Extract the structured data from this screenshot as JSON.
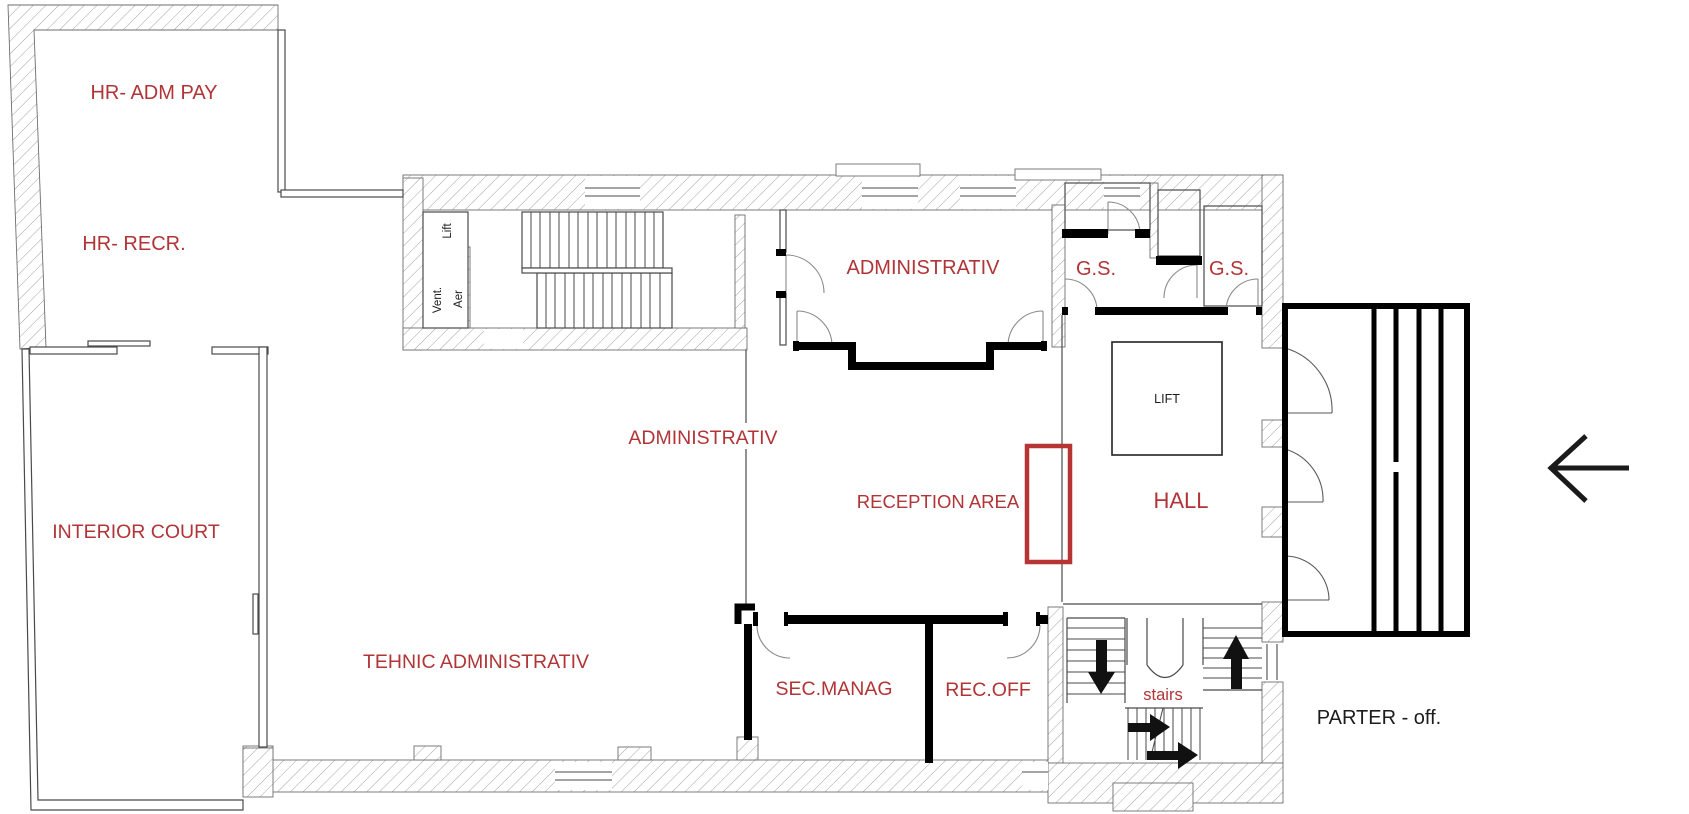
{
  "plan": {
    "floor_label": "PARTER - off.",
    "rooms": {
      "hr_adm_pay": "HR- ADM PAY",
      "hr_recr": "HR- RECR.",
      "interior_court": "INTERIOR COURT",
      "tehnic_administrativ": "TEHNIC ADMINISTRATIV",
      "administrativ_corridor": "ADMINISTRATIV",
      "administrativ_room": "ADMINISTRATIV",
      "reception_area": "RECEPTION AREA",
      "hall": "HALL",
      "gs_left": "G.S.",
      "gs_right": "G.S.",
      "sec_manag": "SEC.MANAG",
      "rec_off": "REC.OFF",
      "stairs": "stairs"
    },
    "service": {
      "lift_box": "LIFT",
      "lift_small": "Lift",
      "vent": "Vent.",
      "aer": "Aer"
    },
    "colors": {
      "label_red": "#b13437",
      "desk_red": "#b63433",
      "wall_black": "#000000",
      "line_gray": "#4a4a4a",
      "hatch_gray": "#9a9a9a"
    }
  }
}
